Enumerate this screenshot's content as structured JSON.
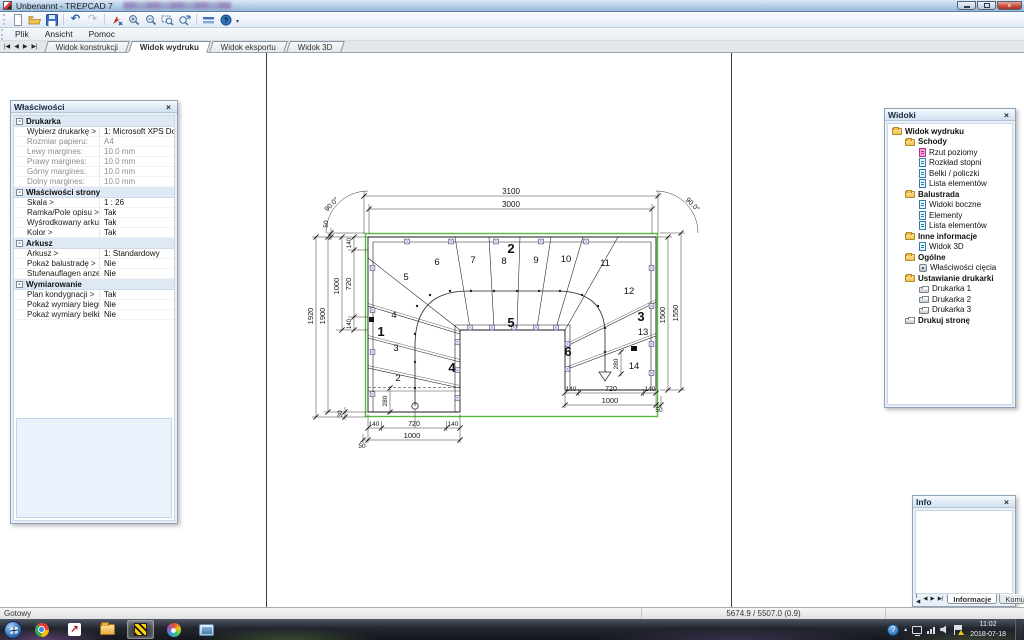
{
  "window": {
    "title": "Unbenannt - TREPCAD 7"
  },
  "icons": {
    "close": "×",
    "minus": "-",
    "help": "?",
    "overflow": "▾",
    "caret": "▴",
    "undo": "↶",
    "redo": "↷",
    "arrow_up_right": "↗",
    "nav_first": "|◀",
    "nav_prev": "◀",
    "nav_next": "▶",
    "nav_last": "▶|"
  },
  "menubar": {
    "items": [
      {
        "label": "Plik"
      },
      {
        "label": "Ansicht"
      },
      {
        "label": "Pomoc"
      }
    ]
  },
  "toolbar": {
    "icons": [
      "new-document",
      "open-folder",
      "save",
      "undo",
      "redo",
      "move-tool",
      "zoom-in",
      "zoom-out",
      "zoom-window",
      "zoom-fit",
      "measure",
      "help"
    ]
  },
  "view_tabs": {
    "items": [
      {
        "label": "Widok konstrukcji",
        "active": false
      },
      {
        "label": "Widok wydruku",
        "active": true
      },
      {
        "label": "Widok eksportu",
        "active": false
      },
      {
        "label": "Widok 3D",
        "active": false
      }
    ]
  },
  "properties_panel": {
    "title": "Właściwości",
    "groups": [
      {
        "label": "Drukarka",
        "rows": [
          {
            "label": "Wybierz drukarkę >",
            "value": "1: Microsoft XPS Docume..."
          },
          {
            "label": "Rozmiar papieru:",
            "value": "A4"
          },
          {
            "label": "Lewy margines:",
            "value": "10.0 mm"
          },
          {
            "label": "Prawy margines:",
            "value": "10.0 mm"
          },
          {
            "label": "Górny margines:",
            "value": "10.0 mm"
          },
          {
            "label": "Dolny margines:",
            "value": "10.0 mm"
          }
        ]
      },
      {
        "label": "Właściwości strony",
        "rows": [
          {
            "label": "Skala >",
            "value": "1 : 26"
          },
          {
            "label": "Ramka/Pole opisu >",
            "value": "Tak"
          },
          {
            "label": "Wyśrodkowany arkusz...",
            "value": "Tak"
          },
          {
            "label": "Kolor >",
            "value": "Tak"
          }
        ]
      },
      {
        "label": "Arkusz",
        "rows": [
          {
            "label": "Arkusz >",
            "value": "1: Standardowy"
          },
          {
            "label": "Pokaż balustradę >",
            "value": "Nie"
          },
          {
            "label": "Stufenauflagen anzeig...",
            "value": "Nie"
          }
        ]
      },
      {
        "label": "Wymiarowanie",
        "rows": [
          {
            "label": "Plan kondygnacji >",
            "value": "Tak"
          },
          {
            "label": "Pokaż wymiary biegu >",
            "value": "Nie"
          },
          {
            "label": "Pokaż wymiary belki >",
            "value": "Nie"
          }
        ]
      }
    ]
  },
  "views_panel": {
    "title": "Widoki",
    "tree": [
      {
        "label": "Widok wydruku",
        "icon": "folder",
        "level": 0
      },
      {
        "label": "Schody",
        "icon": "folder",
        "level": 1
      },
      {
        "label": "Rzut poziomy",
        "icon": "page-pink",
        "level": 2
      },
      {
        "label": "Rozkład stopni",
        "icon": "page-blue",
        "level": 2
      },
      {
        "label": "Belki / policzki",
        "icon": "page-blue",
        "level": 2
      },
      {
        "label": "Lista elementów",
        "icon": "page-blue",
        "level": 2
      },
      {
        "label": "Balustrada",
        "icon": "folder",
        "level": 1
      },
      {
        "label": "Widoki boczne",
        "icon": "page-blue",
        "level": 2
      },
      {
        "label": "Elementy",
        "icon": "page-blue",
        "level": 2
      },
      {
        "label": "Lista elementów",
        "icon": "page-blue",
        "level": 2
      },
      {
        "label": "Inne informacje",
        "icon": "folder",
        "level": 1
      },
      {
        "label": "Widok 3D",
        "icon": "page-blue",
        "level": 2
      },
      {
        "label": "Ogólne",
        "icon": "folder",
        "level": 1
      },
      {
        "label": "Właściwości cięcia",
        "icon": "tool",
        "level": 2
      },
      {
        "label": "Ustawianie drukarki",
        "icon": "folder",
        "level": 1
      },
      {
        "label": "Drukarka 1",
        "icon": "printer",
        "level": 2
      },
      {
        "label": "Drukarka 2",
        "icon": "printer",
        "level": 2
      },
      {
        "label": "Drukarka 3",
        "icon": "printer",
        "level": 2
      },
      {
        "label": "Drukuj stronę",
        "icon": "printer",
        "level": 1
      }
    ]
  },
  "info_panel": {
    "title": "Info",
    "tabs": [
      {
        "label": "Informacje",
        "active": true
      },
      {
        "label": "Komun",
        "active": false
      }
    ]
  },
  "statusbar": {
    "status": "Gotowy",
    "coordinates": "5674.9 / 5507.0 (0.9)"
  },
  "taskbar": {
    "icons": [
      "start",
      "chrome",
      "navigator",
      "file-explorer",
      "trepcad",
      "paint",
      "photo-viewer"
    ],
    "clock": {
      "time": "11:02",
      "date": "2018-07-18"
    }
  },
  "drawing": {
    "dim_top_outer": "3100",
    "dim_top_inner": "3000",
    "angle_left": "90.0°",
    "angle_right": "90.0°",
    "dim_left_outer": "1920",
    "dim_left_inner": "1900",
    "dim_left_flight": "1000",
    "dim_left_walk": "720",
    "dim_left_gap": "50",
    "dim_left_seg_top": "140",
    "dim_left_seg_bot": "140",
    "dim_left_bottom_gap": "30",
    "dim_right_inner": "1500",
    "dim_right_outer": "1550",
    "dim_bl_seg1": "140",
    "dim_bl_walk": "720",
    "dim_bl_seg2": "140",
    "dim_bl_total": "1000",
    "dim_bl_gap": "50",
    "dim_br_seg1": "140",
    "dim_br_walk": "720",
    "dim_br_seg2": "140",
    "dim_br_total": "1000",
    "dim_br_gap": "50",
    "dim_walk_start": "280",
    "dim_walk_end": "280",
    "steps": {
      "n2": "2",
      "n3": "3",
      "n4": "4",
      "n5": "5",
      "n6": "6",
      "n7": "7",
      "n8": "8",
      "n9": "9",
      "n10": "10",
      "n11": "11",
      "n12": "12",
      "n13": "13",
      "n14": "14"
    },
    "beams": {
      "b1": "1",
      "b2": "2",
      "b3": "3",
      "b4": "4",
      "b5": "5",
      "b6": "6"
    }
  }
}
